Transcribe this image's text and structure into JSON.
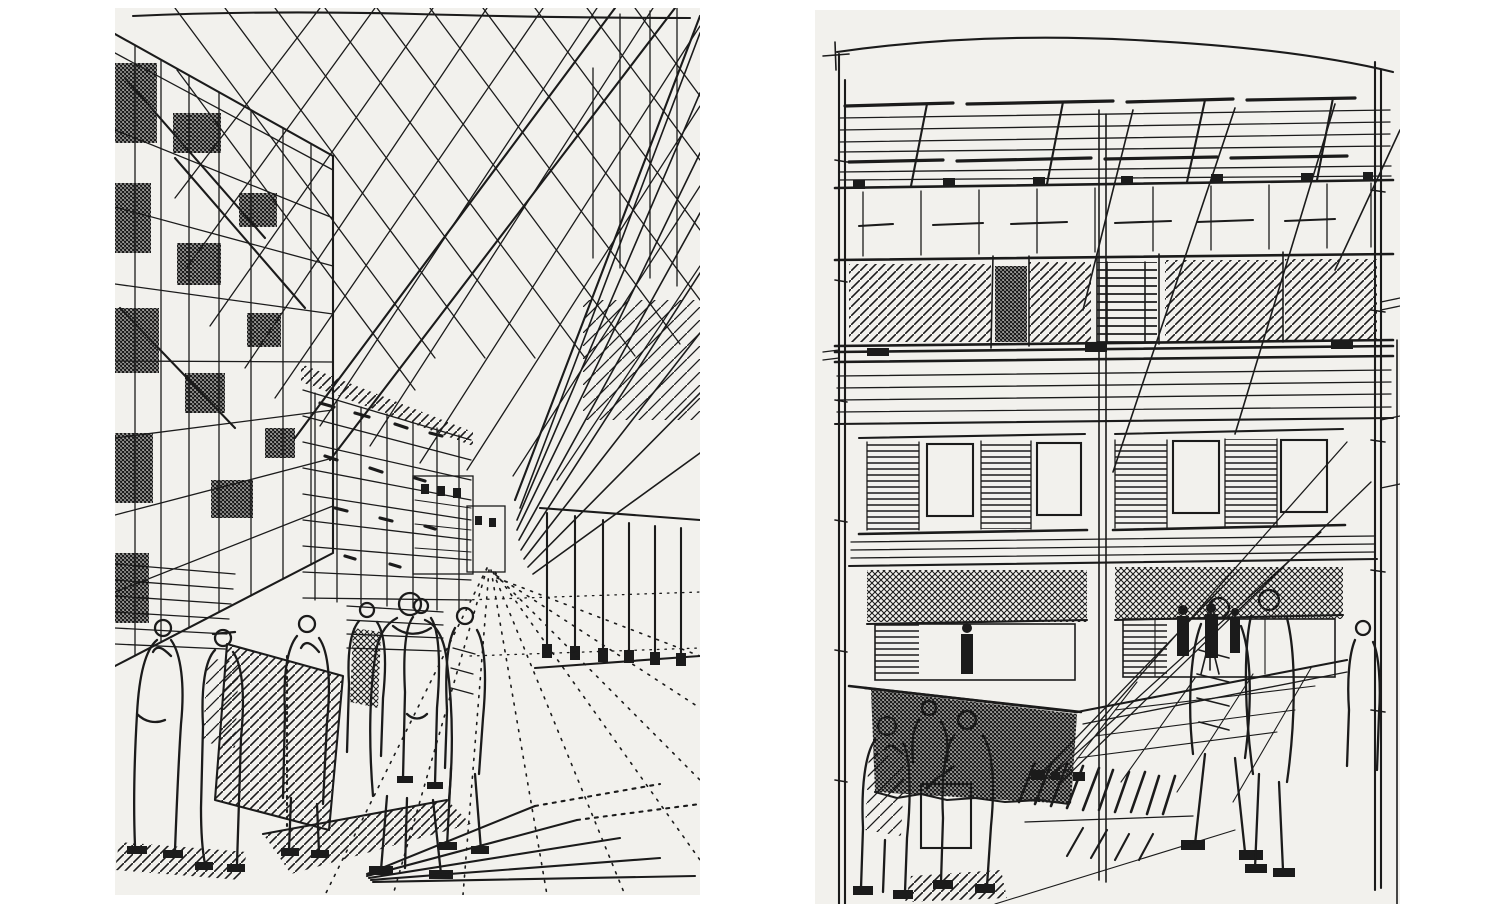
{
  "colors": {
    "ink": "#1b1b1b",
    "paper": "#f2f1ed",
    "page": "#ffffff"
  },
  "artwork": {
    "medium": "Pen-and-ink architectural sketches, black ink on paper, two panels side by side",
    "panels": [
      {
        "id": "left",
        "title": "Street perspective sketch",
        "description": "One-point perspective view down a pedestrian street: tall cross-hatched facade on the left, overhead lattice of crossing cables forming diamonds in the sky, mid-rise buildings toward the vanishing point, a colonnaded building on the right, a crowd of sketched pedestrians in the foreground and dotted paving joints converging on the street.",
        "figure_count": 7
      },
      {
        "id": "right",
        "title": "Facade elevation sketch",
        "description": "Front elevation of a three-storey building: rooftop canopy of long horizontal members with diagonal struts, a band of diagonally hatched panels, louvred window bays with dark cross-hatched openings, a cross-hatched undercroft, diagonal stay cables, and groups of figures standing on the plaza below.",
        "figure_count": 6
      }
    ]
  }
}
